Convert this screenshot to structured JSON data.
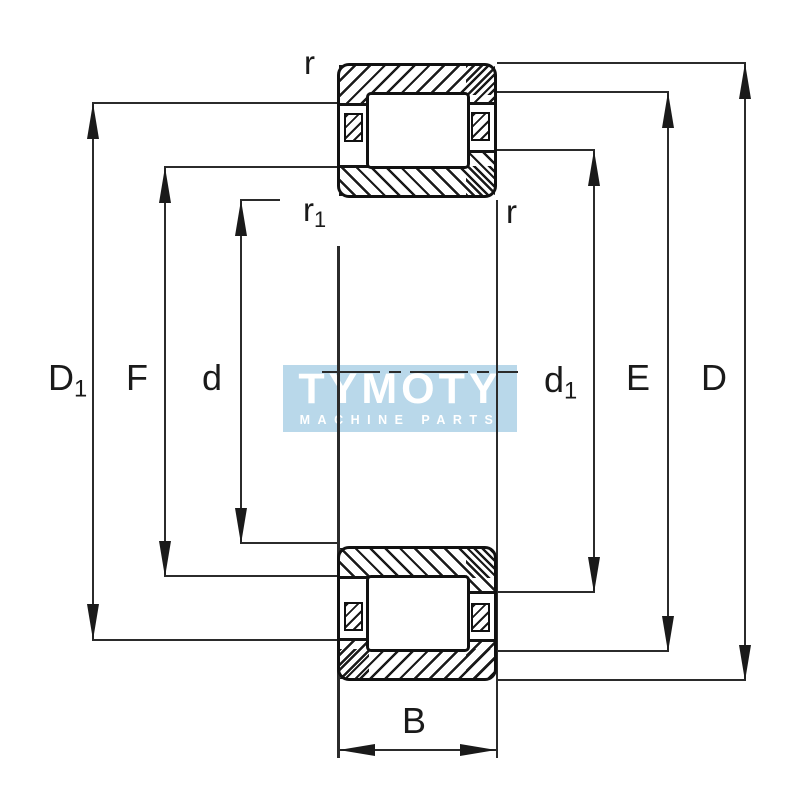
{
  "page": {
    "background": "#ffffff"
  },
  "drawing": {
    "description": "Cylindrical roller bearing cross-section technical drawing (NJ design) with dimension annotations",
    "line_color": "#1a1a1a",
    "labels": {
      "D1": {
        "main": "D",
        "sub": "1"
      },
      "F": {
        "main": "F",
        "sub": ""
      },
      "d": {
        "main": "d",
        "sub": ""
      },
      "d1": {
        "main": "d",
        "sub": "1"
      },
      "E": {
        "main": "E",
        "sub": ""
      },
      "D": {
        "main": "D",
        "sub": ""
      },
      "B": {
        "main": "B",
        "sub": ""
      },
      "r_top_left": {
        "main": "r",
        "sub": ""
      },
      "r1_mid_left": {
        "main": "r",
        "sub": "1"
      },
      "r_mid_right": {
        "main": "r",
        "sub": ""
      }
    }
  },
  "watermark": {
    "title": "TYMOTY",
    "subtitle": "MACHINE PARTS",
    "bg_color": "#b9d8ea",
    "text_color": "#ffffff"
  }
}
